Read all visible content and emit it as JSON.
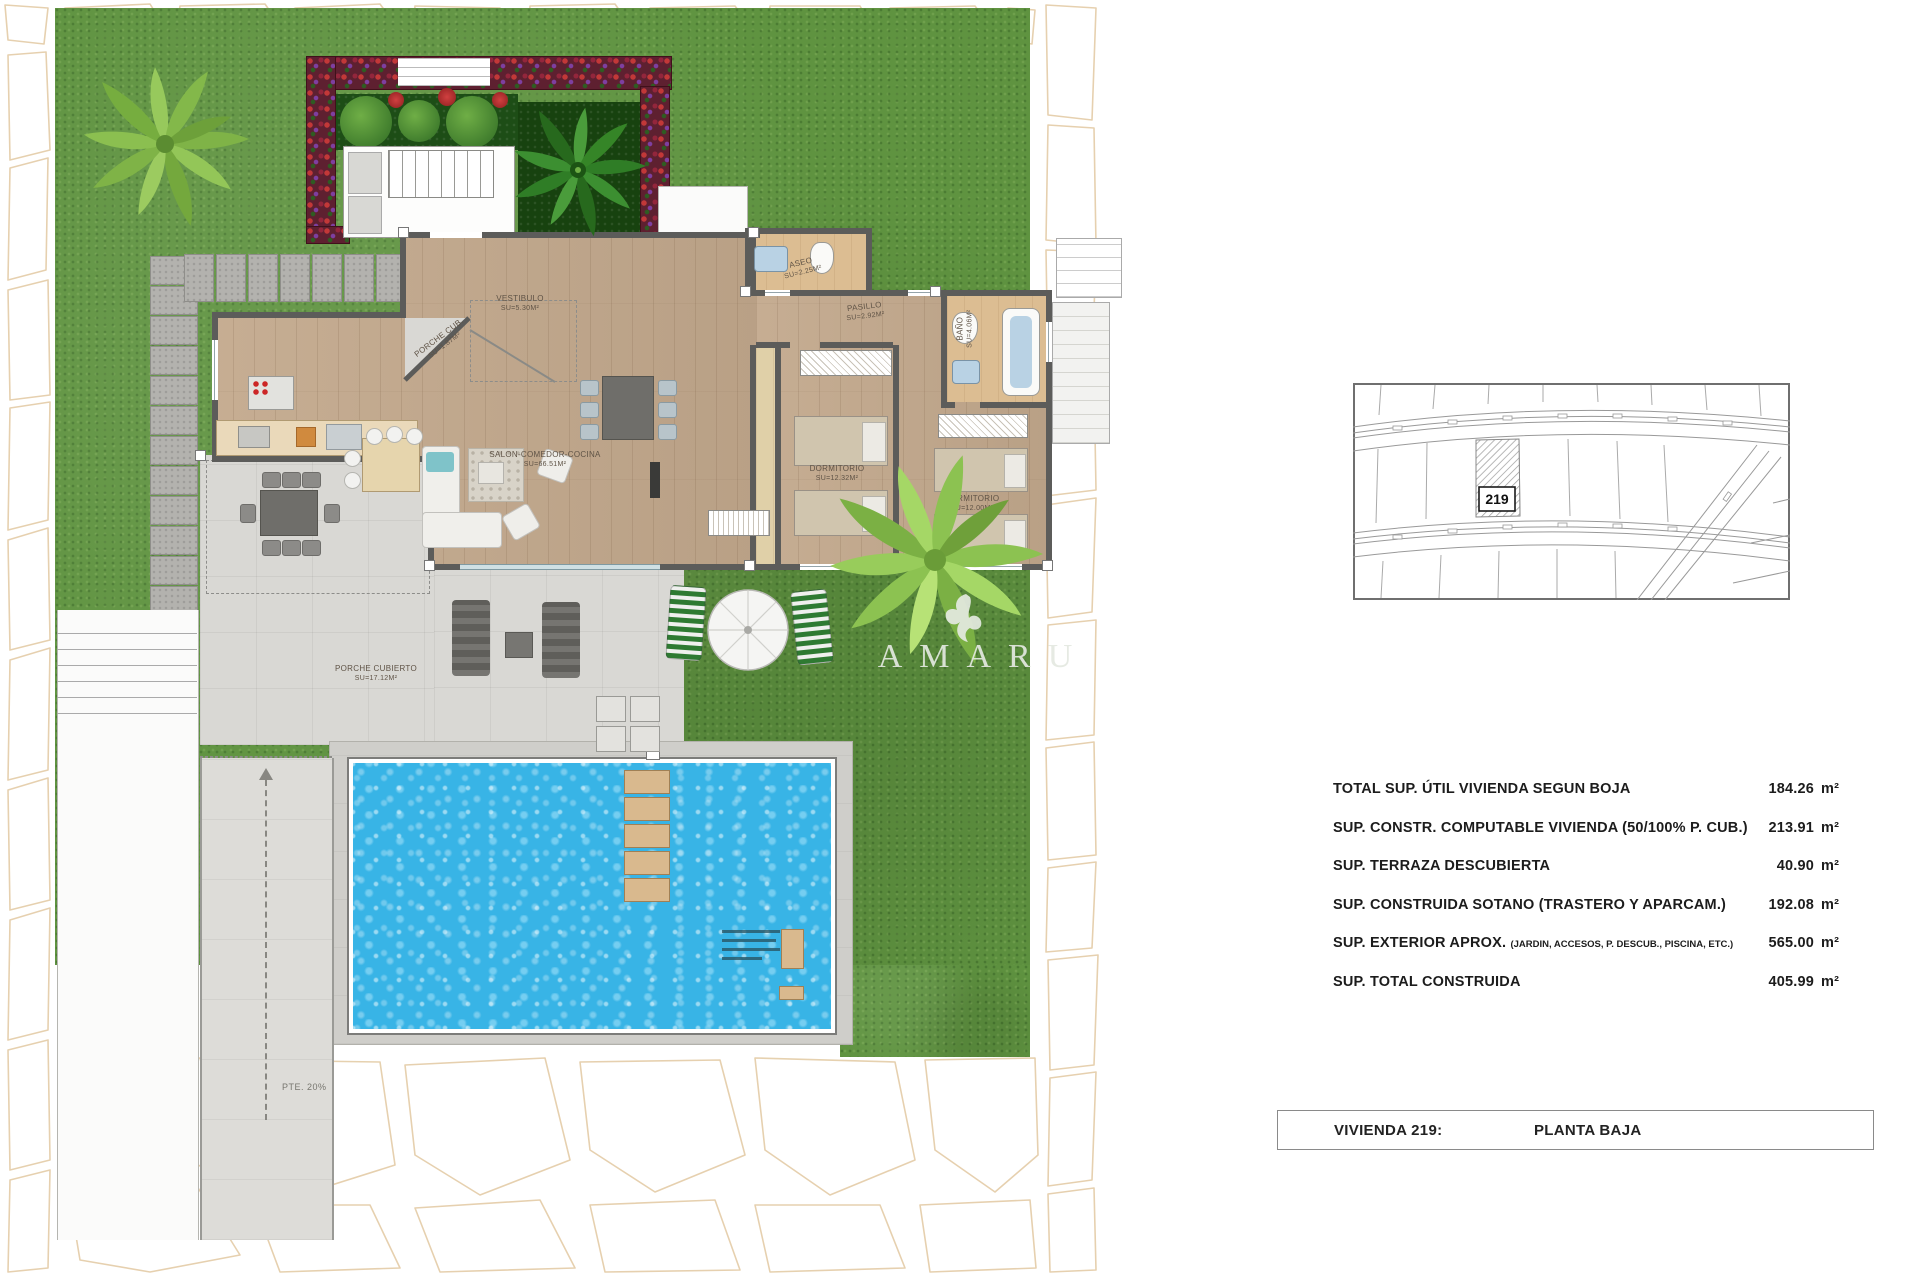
{
  "brand": {
    "logo_text": "AMARU"
  },
  "floor_plan": {
    "rooms": [
      {
        "id": "vestibulo",
        "name": "VESTIBULO",
        "area": "Su=5.30m²"
      },
      {
        "id": "porche-cub",
        "name": "PORCHE CUB.",
        "area": "Su=1.87m²"
      },
      {
        "id": "salon",
        "name": "SALON-COMEDOR-COCINA",
        "area": "Su=66.51m²"
      },
      {
        "id": "aseo",
        "name": "ASEO",
        "area": "Su=2.25m²"
      },
      {
        "id": "pasillo",
        "name": "PASILLO",
        "area": "Su=2.92m²"
      },
      {
        "id": "bano",
        "name": "BAÑO",
        "area": "Su=4.06m²"
      },
      {
        "id": "dormitorio-1",
        "name": "DORMITORIO",
        "area": "Su=12.32m²"
      },
      {
        "id": "dormitorio-2",
        "name": "DORMITORIO",
        "area": "Su=12.00m²"
      },
      {
        "id": "porche-cubierto",
        "name": "PORCHE CUBIERTO",
        "area": "Su=17.12m²"
      }
    ],
    "ramp_label": "PTE. 20%"
  },
  "site_plan": {
    "parcel_label": "219"
  },
  "areas_table": {
    "rows": [
      {
        "label": "TOTAL SUP. ÚTIL VIVIENDA SEGUN BOJA",
        "sublabel": "",
        "value": "184.26",
        "unit": "m²"
      },
      {
        "label": "SUP. CONSTR. COMPUTABLE VIVIENDA (50/100% P. CUB.)",
        "sublabel": "",
        "value": "213.91",
        "unit": "m²"
      },
      {
        "label": "SUP. TERRAZA DESCUBIERTA",
        "sublabel": "",
        "value": "40.90",
        "unit": "m²"
      },
      {
        "label": "SUP. CONSTRUIDA SOTANO (TRASTERO Y APARCAM.)",
        "sublabel": "",
        "value": "192.08",
        "unit": "m²"
      },
      {
        "label": "SUP. EXTERIOR APROX.",
        "sublabel": "(JARDIN, ACCESOS, P. DESCUB., PISCINA, ETC.)",
        "value": "565.00",
        "unit": "m²"
      },
      {
        "label": "SUP. TOTAL CONSTRUIDA",
        "sublabel": "",
        "value": "405.99",
        "unit": "m²"
      }
    ]
  },
  "title_bar": {
    "left": "VIVIENDA 219:",
    "right": "PLANTA BAJA"
  },
  "colors": {
    "grass": "#5f9340",
    "pool_water": "#38b4e6",
    "wood_floor": "#c3a98d",
    "tile_floor": "#dcbd92",
    "terrace": "#d9d8d4",
    "flower_bed": "#5e2030",
    "stone_outline": "#d2ab6e"
  }
}
